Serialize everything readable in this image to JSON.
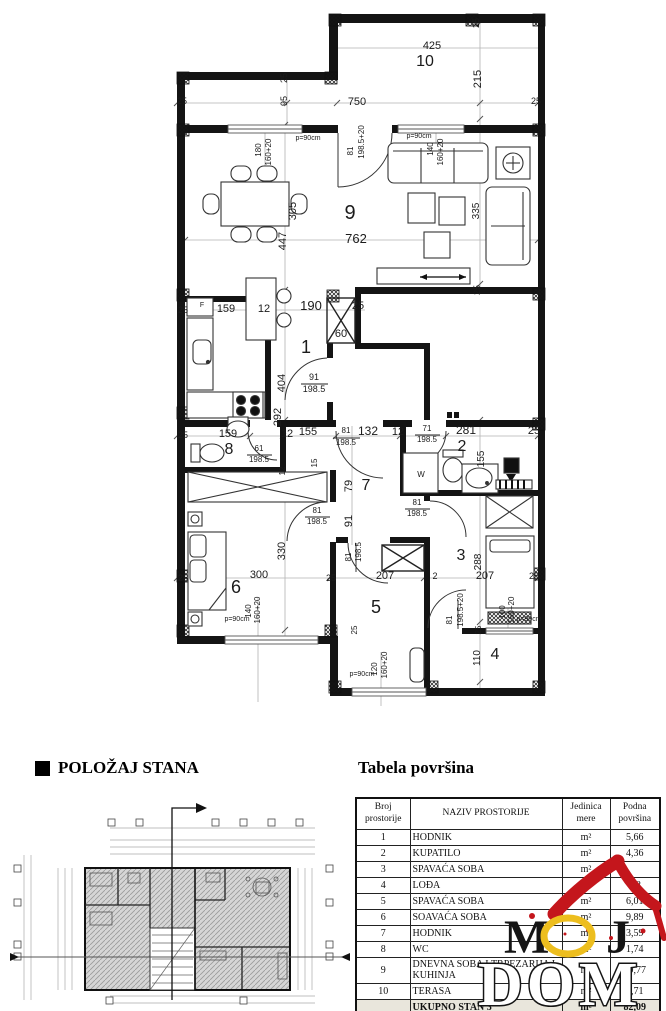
{
  "polozaj": {
    "title": "POLOŽAJ STANA"
  },
  "table": {
    "title": "Tabela površina",
    "col_headers": [
      "Broj prostorije",
      "NAZIV PROSTORIJE",
      "Jedinica mere",
      "Podna površina"
    ],
    "rows": [
      {
        "no": "1",
        "name": "HODNIK",
        "unit": "m²",
        "area": "5,66"
      },
      {
        "no": "2",
        "name": "KUPATILO",
        "unit": "m²",
        "area": "4,36"
      },
      {
        "no": "3",
        "name": "SPAVAĆA SOBA",
        "unit": "m²",
        "area": ""
      },
      {
        "no": "4",
        "name": "LOĐA",
        "unit": "m²",
        "area": "2,2"
      },
      {
        "no": "5",
        "name": "SPAVAĆA SOBA",
        "unit": "m²",
        "area": "6,01"
      },
      {
        "no": "6",
        "name": "SOAVAĆA SOBA",
        "unit": "m²",
        "area": "9,89"
      },
      {
        "no": "7",
        "name": "HODNIK",
        "unit": "m²",
        "area": "3,59"
      },
      {
        "no": "8",
        "name": "WC",
        "unit": "m²",
        "area": "1,74"
      },
      {
        "no": "9",
        "name": "DNEVNA SOBA I TRPEZARIJA I KUHINJA",
        "unit": "m²",
        "area": "29,77"
      },
      {
        "no": "10",
        "name": "TERASA",
        "unit": "m²",
        "area": "2,71"
      }
    ],
    "total_row": {
      "no": "",
      "name": "UKUPNO STAN 3",
      "unit": "m²",
      "area": "82,09"
    }
  },
  "logo": {
    "m": "M",
    "j": "J",
    "dom": "DOM",
    "red": "#c4161c",
    "yellow": "#edbe1e"
  },
  "plan": {
    "label_format": [
      "text",
      "x",
      "y",
      "rotated",
      "font_size"
    ],
    "labels": [
      [
        "425",
        432,
        49,
        0,
        11
      ],
      [
        "10",
        425,
        66,
        0,
        16
      ],
      [
        "215",
        481,
        79,
        1,
        11
      ],
      [
        "25",
        479,
        23,
        1,
        9
      ],
      [
        "25",
        287,
        78,
        1,
        9
      ],
      [
        "25",
        182,
        104,
        0,
        9
      ],
      [
        "750",
        357,
        105,
        0,
        11
      ],
      [
        "95",
        287,
        101,
        1,
        9
      ],
      [
        "25",
        536,
        104,
        0,
        9
      ],
      [
        "p=90cm",
        308,
        140,
        0,
        7
      ],
      [
        "180",
        261,
        150,
        1,
        8
      ],
      [
        "160+20",
        271,
        152,
        1,
        8
      ],
      [
        "81",
        353,
        151,
        1,
        8
      ],
      [
        "198.5+20",
        364,
        142,
        1,
        8
      ],
      [
        "p=90cm",
        419,
        138,
        0,
        7
      ],
      [
        "140",
        433,
        149,
        1,
        8
      ],
      [
        "160+20",
        443,
        152,
        1,
        8
      ],
      [
        "9",
        350,
        219,
        0,
        20
      ],
      [
        "762",
        356,
        243,
        0,
        13
      ],
      [
        "305",
        296,
        211,
        1,
        11
      ],
      [
        "447",
        286,
        241,
        1,
        11
      ],
      [
        "335",
        479,
        211,
        1,
        10
      ],
      [
        "25",
        480,
        290,
        1,
        9
      ],
      [
        "25",
        183,
        313,
        0,
        9
      ],
      [
        "159",
        226,
        312,
        0,
        11
      ],
      [
        "12",
        264,
        312,
        0,
        11
      ],
      [
        "190",
        311,
        310,
        0,
        13
      ],
      [
        "25",
        358,
        309,
        0,
        11
      ],
      [
        "60",
        341,
        337,
        0,
        11
      ],
      [
        "1",
        306,
        353,
        0,
        18
      ],
      [
        "F",
        202,
        307,
        0,
        7
      ],
      [
        "91",
        314,
        380,
        0,
        9
      ],
      [
        "198.5",
        314,
        392,
        0,
        9
      ],
      [
        "404",
        285,
        383,
        1,
        11
      ],
      [
        "292",
        281,
        417,
        1,
        11
      ],
      [
        "25",
        183,
        438,
        0,
        9
      ],
      [
        "159",
        228,
        437,
        0,
        11
      ],
      [
        "12",
        287,
        437,
        0,
        11
      ],
      [
        "155",
        308,
        435,
        0,
        11
      ],
      [
        "81",
        346,
        433,
        0,
        8
      ],
      [
        "198.5",
        346,
        445,
        0,
        8
      ],
      [
        "132",
        368,
        435,
        0,
        12
      ],
      [
        "12",
        398,
        435,
        0,
        11
      ],
      [
        "71",
        427,
        431,
        0,
        8
      ],
      [
        "198.5",
        427,
        442,
        0,
        8
      ],
      [
        "281",
        466,
        434,
        0,
        12
      ],
      [
        "25",
        534,
        434,
        0,
        11
      ],
      [
        "8",
        229,
        454,
        0,
        16
      ],
      [
        "61",
        259,
        451,
        0,
        8
      ],
      [
        "198.5",
        259,
        462,
        0,
        8
      ],
      [
        "2",
        462,
        451,
        0,
        16
      ],
      [
        "155",
        484,
        459,
        1,
        10
      ],
      [
        "W",
        421,
        477,
        0,
        8
      ],
      [
        "12",
        285,
        471,
        1,
        8
      ],
      [
        "15",
        317,
        463,
        1,
        8
      ],
      [
        "79",
        352,
        486,
        1,
        11
      ],
      [
        "7",
        366,
        490,
        0,
        16
      ],
      [
        "91",
        352,
        521,
        1,
        11
      ],
      [
        "81",
        317,
        513,
        0,
        8
      ],
      [
        "198.5",
        317,
        524,
        0,
        8
      ],
      [
        "81",
        417,
        505,
        0,
        8
      ],
      [
        "198.5",
        417,
        516,
        0,
        8
      ],
      [
        "330",
        285,
        551,
        1,
        11
      ],
      [
        "3",
        461,
        560,
        0,
        16
      ],
      [
        "288",
        481,
        562,
        1,
        10
      ],
      [
        "81",
        351,
        557,
        1,
        8
      ],
      [
        "198.5",
        361,
        552,
        1,
        8
      ],
      [
        "25",
        183,
        581,
        0,
        9
      ],
      [
        "300",
        259,
        578,
        0,
        11
      ],
      [
        "6",
        236,
        593,
        0,
        18
      ],
      [
        "25",
        331,
        581,
        0,
        9
      ],
      [
        "207",
        385,
        579,
        0,
        11
      ],
      [
        "2",
        435,
        579,
        0,
        9
      ],
      [
        "207",
        485,
        579,
        0,
        11
      ],
      [
        "25",
        534,
        579,
        0,
        9
      ],
      [
        "5",
        376,
        613,
        0,
        18
      ],
      [
        "81",
        452,
        620,
        1,
        8
      ],
      [
        "198.5+20",
        463,
        610,
        1,
        8
      ],
      [
        "25",
        481,
        630,
        1,
        8
      ],
      [
        "110",
        480,
        658,
        1,
        10
      ],
      [
        "4",
        495,
        659,
        0,
        16
      ],
      [
        "p=90cm",
        237,
        621,
        0,
        7
      ],
      [
        "140",
        251,
        611,
        1,
        8
      ],
      [
        "160+20",
        260,
        610,
        1,
        8
      ],
      [
        "p=90cm",
        362,
        676,
        0,
        7
      ],
      [
        "120",
        377,
        669,
        1,
        8
      ],
      [
        "160+20",
        387,
        665,
        1,
        8
      ],
      [
        "100",
        505,
        612,
        1,
        8
      ],
      [
        "160+20",
        514,
        610,
        1,
        8
      ],
      [
        "p=90cm",
        529,
        621,
        0,
        7
      ],
      [
        "25",
        357,
        630,
        1,
        8
      ]
    ]
  }
}
